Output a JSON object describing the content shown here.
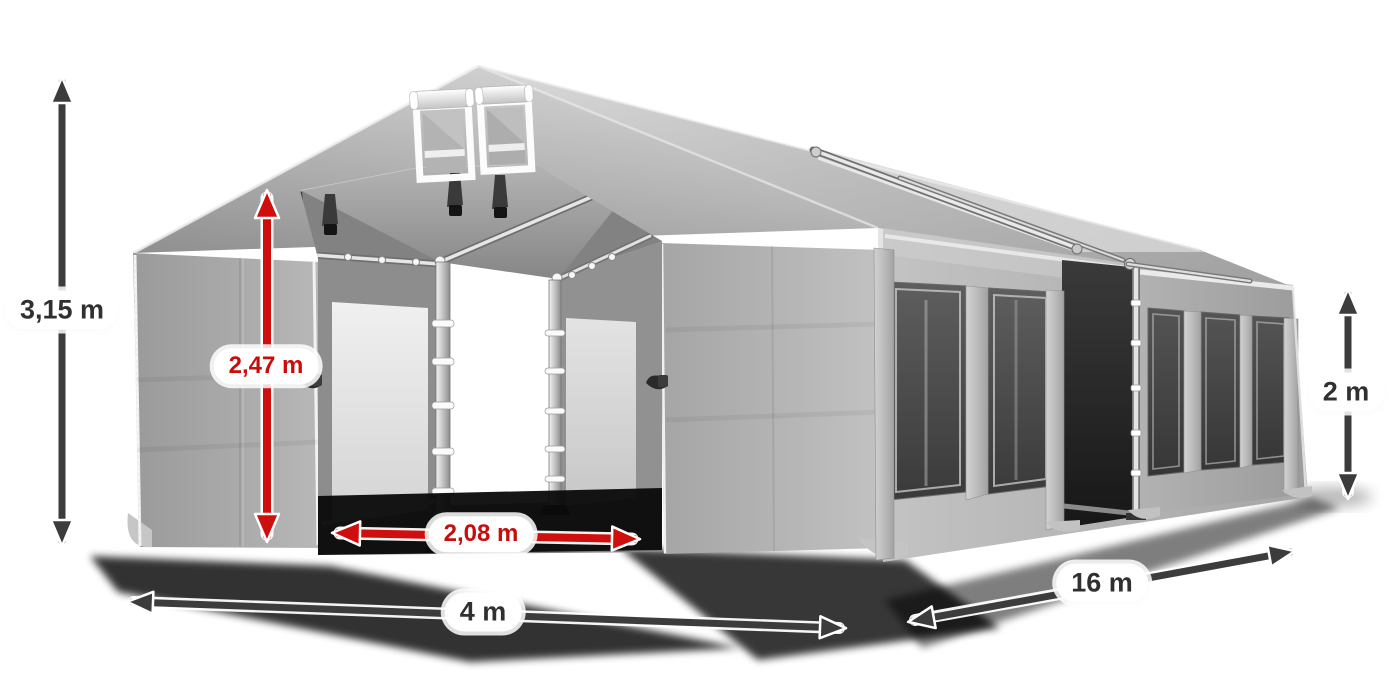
{
  "page": {
    "background": "#ffffff",
    "description": "Product illustration of a grey PVC storage / party tent shown in three-quarter view with open front doors, roll-up gable vents, dark side windows and dimension arrows"
  },
  "tent": {
    "fabric_light": "#c6c6c6",
    "fabric_mid": "#a9a9a9",
    "fabric_dark": "#8a8a8a",
    "roof_highlight": "#d6d6d6",
    "window_glass": "#454545",
    "interior": "#262626",
    "mesh_panel": "#e9e9e9",
    "frame_pole": "#d9d9d9",
    "trim": "#f0f0f0",
    "shadow": "#000000",
    "features": [
      "gable roof with ridge connector poles",
      "two roll-up vent windows in the front gable",
      "open double front door with aluminium door posts",
      "see-through interior with ceiling straps",
      "side wall with five dark window panels",
      "open side entrance between modules"
    ]
  },
  "annotations": {
    "arrow_dark_color": "#3c3c3c",
    "arrow_red_color": "#cf0e0e",
    "label_dark_color": "#303030",
    "label_red_color": "#c90d0d",
    "pill_background": "#ffffff",
    "dimensions": [
      {
        "id": "total_height",
        "label": "3,15 m",
        "style": "dark",
        "orientation": "vertical",
        "position": "far-left"
      },
      {
        "id": "door_height",
        "label": "2,47 m",
        "style": "red",
        "orientation": "vertical",
        "position": "front-door-left"
      },
      {
        "id": "door_width",
        "label": "2,08 m",
        "style": "red",
        "orientation": "horizontal",
        "position": "front-door-bottom"
      },
      {
        "id": "front_width",
        "label": "4 m",
        "style": "dark",
        "orientation": "diagonal",
        "position": "bottom-front"
      },
      {
        "id": "side_length",
        "label": "16 m",
        "style": "dark",
        "orientation": "diagonal",
        "position": "bottom-right"
      },
      {
        "id": "side_wall_height",
        "label": "2 m",
        "style": "dark",
        "orientation": "vertical",
        "position": "far-right"
      }
    ]
  }
}
